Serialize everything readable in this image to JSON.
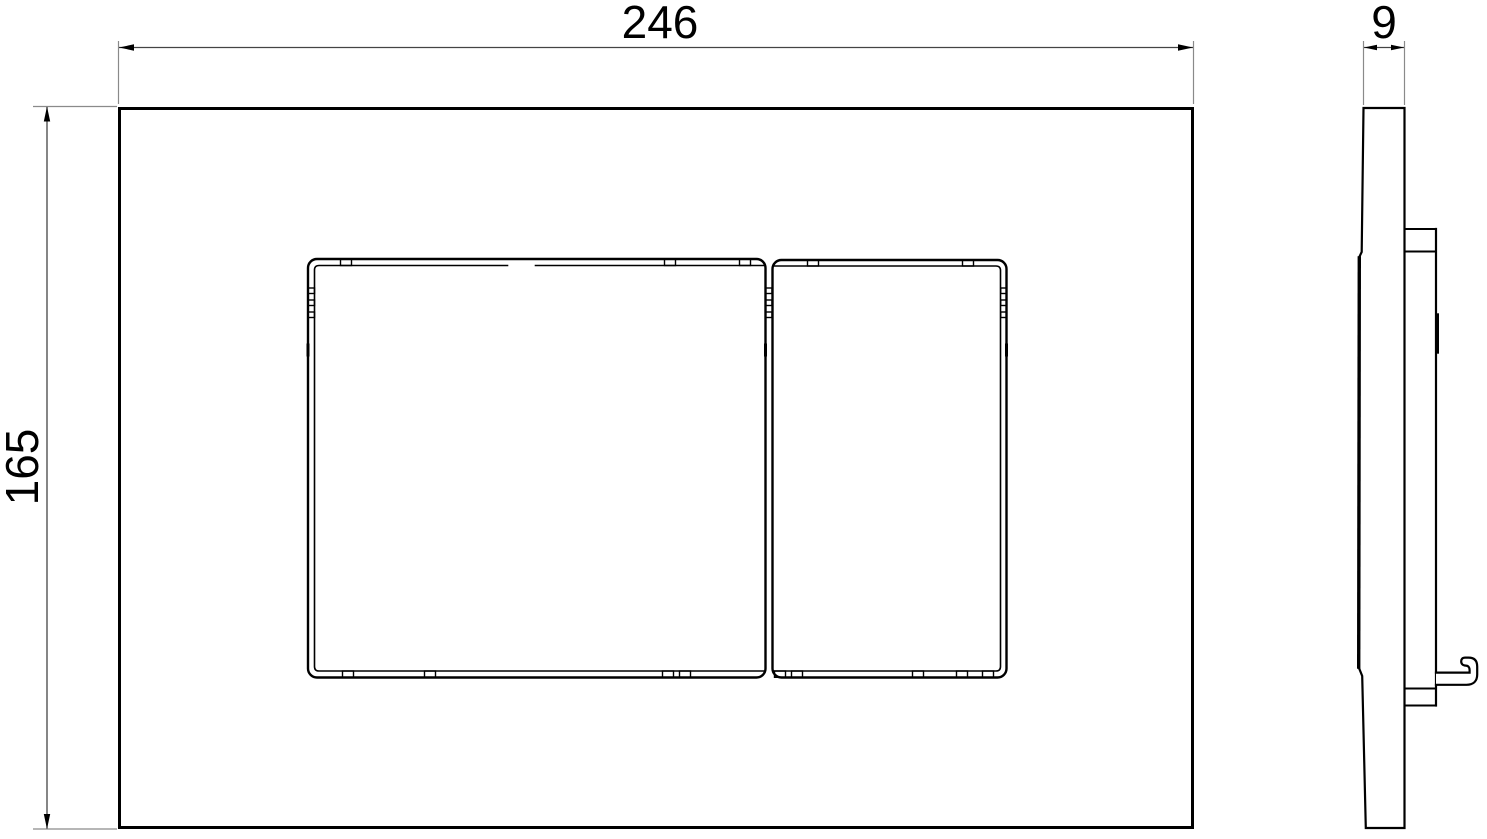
{
  "drawing": {
    "dimensions": {
      "width": "246",
      "height": "165",
      "depth": "9"
    },
    "colors": {
      "outline": "#000000",
      "dimension_line": "#444444",
      "extension_line": "#8a8a8a",
      "text": "#000000",
      "background": "#ffffff"
    }
  }
}
